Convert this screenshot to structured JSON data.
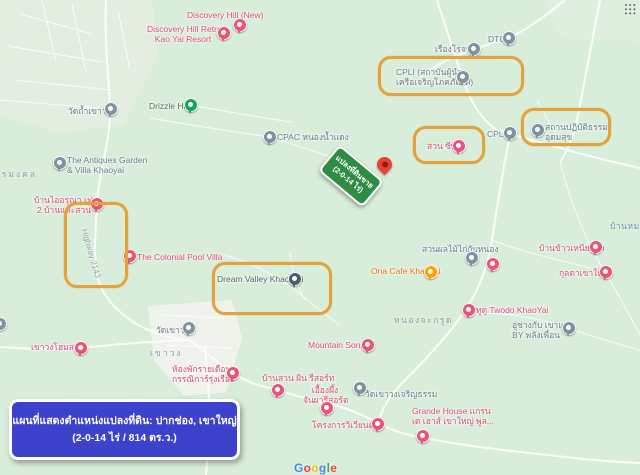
{
  "info_box": {
    "line1": "แผนที่แสดงตำแหน่งแปลงที่ดิน: ปากช่อง, เขาใหญ่",
    "line2": "(2-0-14 ไร่ / 814 ตร.ว.)"
  },
  "land_sign": {
    "line1": "แปลงที่ดินขาย",
    "line2": "(2-0-14 ไร่)"
  },
  "google_logo": {
    "letters": [
      "G",
      "o",
      "o",
      "g",
      "l",
      "e"
    ]
  },
  "road_labels": [
    {
      "label": "Highway 2143"
    }
  ],
  "area_labels": [
    {
      "label": "เขาวง"
    },
    {
      "label": "หนองจะกรูด"
    },
    {
      "label": "ธรรมงคล"
    },
    {
      "label": "บ้านหมาก"
    }
  ],
  "colors": {
    "map_background": "#d8eeda",
    "highlight_orange": "#e5a23a",
    "sign_green": "#2f8c44",
    "info_blue": "#3d42cd",
    "pin_pink": "#e8547a",
    "pin_gray": "#7e93a0",
    "pin_green": "#14a35c",
    "pin_orange": "#ffa000",
    "pin_navy": "#46606e",
    "target_red": "#ea4335"
  },
  "pois": [
    {
      "label": "Discovery Hill (New)"
    },
    {
      "line1": "Discovery Hill Retreat",
      "line2": "Kao Yai Resort"
    },
    {
      "label": "Drizzle Hill"
    },
    {
      "label": "วัดถ้ำเขาวง"
    },
    {
      "label": "CPAC หนองน้ำแดง"
    },
    {
      "line1": "The Antiques Garden",
      "line2": "& Villa Khaoyai"
    },
    {
      "label": "DTC"
    },
    {
      "label": "เรืองโรจน์"
    },
    {
      "line1": "CPLI (สถาบันผู้นำ",
      "line2": "เครือเจริญโภคภัณฑ์)"
    },
    {
      "label": "สวน ซีพี"
    },
    {
      "label": "CPLI"
    },
    {
      "line1": "สถานปฏิบัติธรรม",
      "line2": "อุดมสุข"
    },
    {
      "line1": "บ้านไออรุณา เฟส",
      "line2": "2 บ้านและสวน"
    },
    {
      "label": "The Colonial Pool Villa"
    },
    {
      "label": "Dream Valley Khao Yai"
    },
    {
      "label": "Ona Cafe Khaoyai"
    },
    {
      "label": "สวนผลไม้ไก่กับหน่อง"
    },
    {
      "label": ""
    },
    {
      "label": "บ้านข้าวเหนียวดำ"
    },
    {
      "label": "กุลตาเขาใหญ่"
    },
    {
      "label": "Mountain Sonata"
    },
    {
      "label": "ทูดู Twodo KhaoYai"
    },
    {
      "line1": "อู่ช่างกับ เขาแคน",
      "line2": "BY พลังเพื่อน"
    },
    {
      "label": "เขาวงโฮมสเตย์"
    },
    {
      "label": "วัดเขาวง"
    },
    {
      "line1": "ห้องพักรายเดือน",
      "line2": "กรรณิการ์รุ่งเรือง"
    },
    {
      "label": "บ้านสวน ผิน รีสอร์ท"
    },
    {
      "line1": "เอื้องผึ้ง",
      "line2": "จันผารีสอร์ต"
    },
    {
      "label": "วัดเขาวงเจริญธรรม"
    },
    {
      "label": "โครงการวิเวียนด้า2"
    },
    {
      "line1": "Grande House แกรน",
      "line2": "เด เฮาส์ เขาใหญ่ พูล..."
    }
  ]
}
